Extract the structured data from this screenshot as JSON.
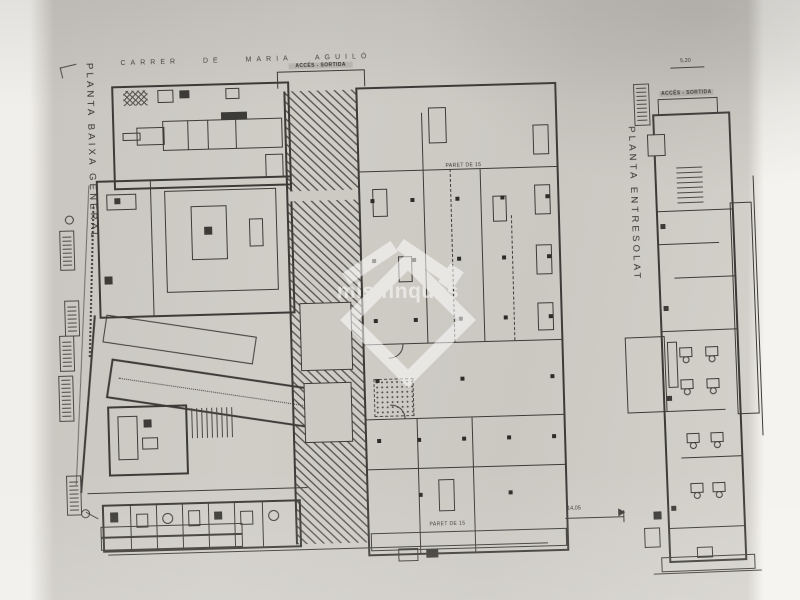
{
  "photo": {
    "paper_color": "#cdcac4",
    "left_band_color": "#f1efeb",
    "right_band_color": "#f5f3ef",
    "line_color": "#3d3b37"
  },
  "watermark": {
    "text": "mls finques"
  },
  "ground_floor": {
    "title": "PLANTA BAIXA GENERAL",
    "street_top": "CARRER DE MARIA AGUILÓ",
    "access_label": "ACCÉS - SORTIDA",
    "wall_note_top": "PARET DE 15",
    "wall_note_bottom": "PARET DE 15",
    "dim_right": "14,05",
    "columns": [
      [
        10,
        110
      ],
      [
        50,
        110
      ],
      [
        95,
        110
      ],
      [
        140,
        110
      ],
      [
        185,
        110
      ],
      [
        10,
        170
      ],
      [
        50,
        170
      ],
      [
        95,
        170
      ],
      [
        140,
        170
      ],
      [
        185,
        170
      ],
      [
        10,
        230
      ],
      [
        50,
        230
      ],
      [
        95,
        230
      ],
      [
        140,
        230
      ],
      [
        185,
        230
      ],
      [
        10,
        290
      ],
      [
        95,
        290
      ],
      [
        185,
        290
      ],
      [
        10,
        350
      ],
      [
        50,
        350
      ],
      [
        95,
        350
      ],
      [
        140,
        350
      ],
      [
        185,
        350
      ],
      [
        50,
        405
      ],
      [
        140,
        405
      ]
    ]
  },
  "mezzanine": {
    "title": "PLANTA ENTRESOLAT",
    "access_label": "ACCÉS - SORTIDA",
    "dim_top": "5,20",
    "desks": [
      [
        16,
        232
      ],
      [
        42,
        232
      ],
      [
        16,
        264
      ],
      [
        42,
        264
      ],
      [
        20,
        318
      ],
      [
        44,
        318
      ],
      [
        22,
        368
      ],
      [
        44,
        368
      ]
    ]
  }
}
